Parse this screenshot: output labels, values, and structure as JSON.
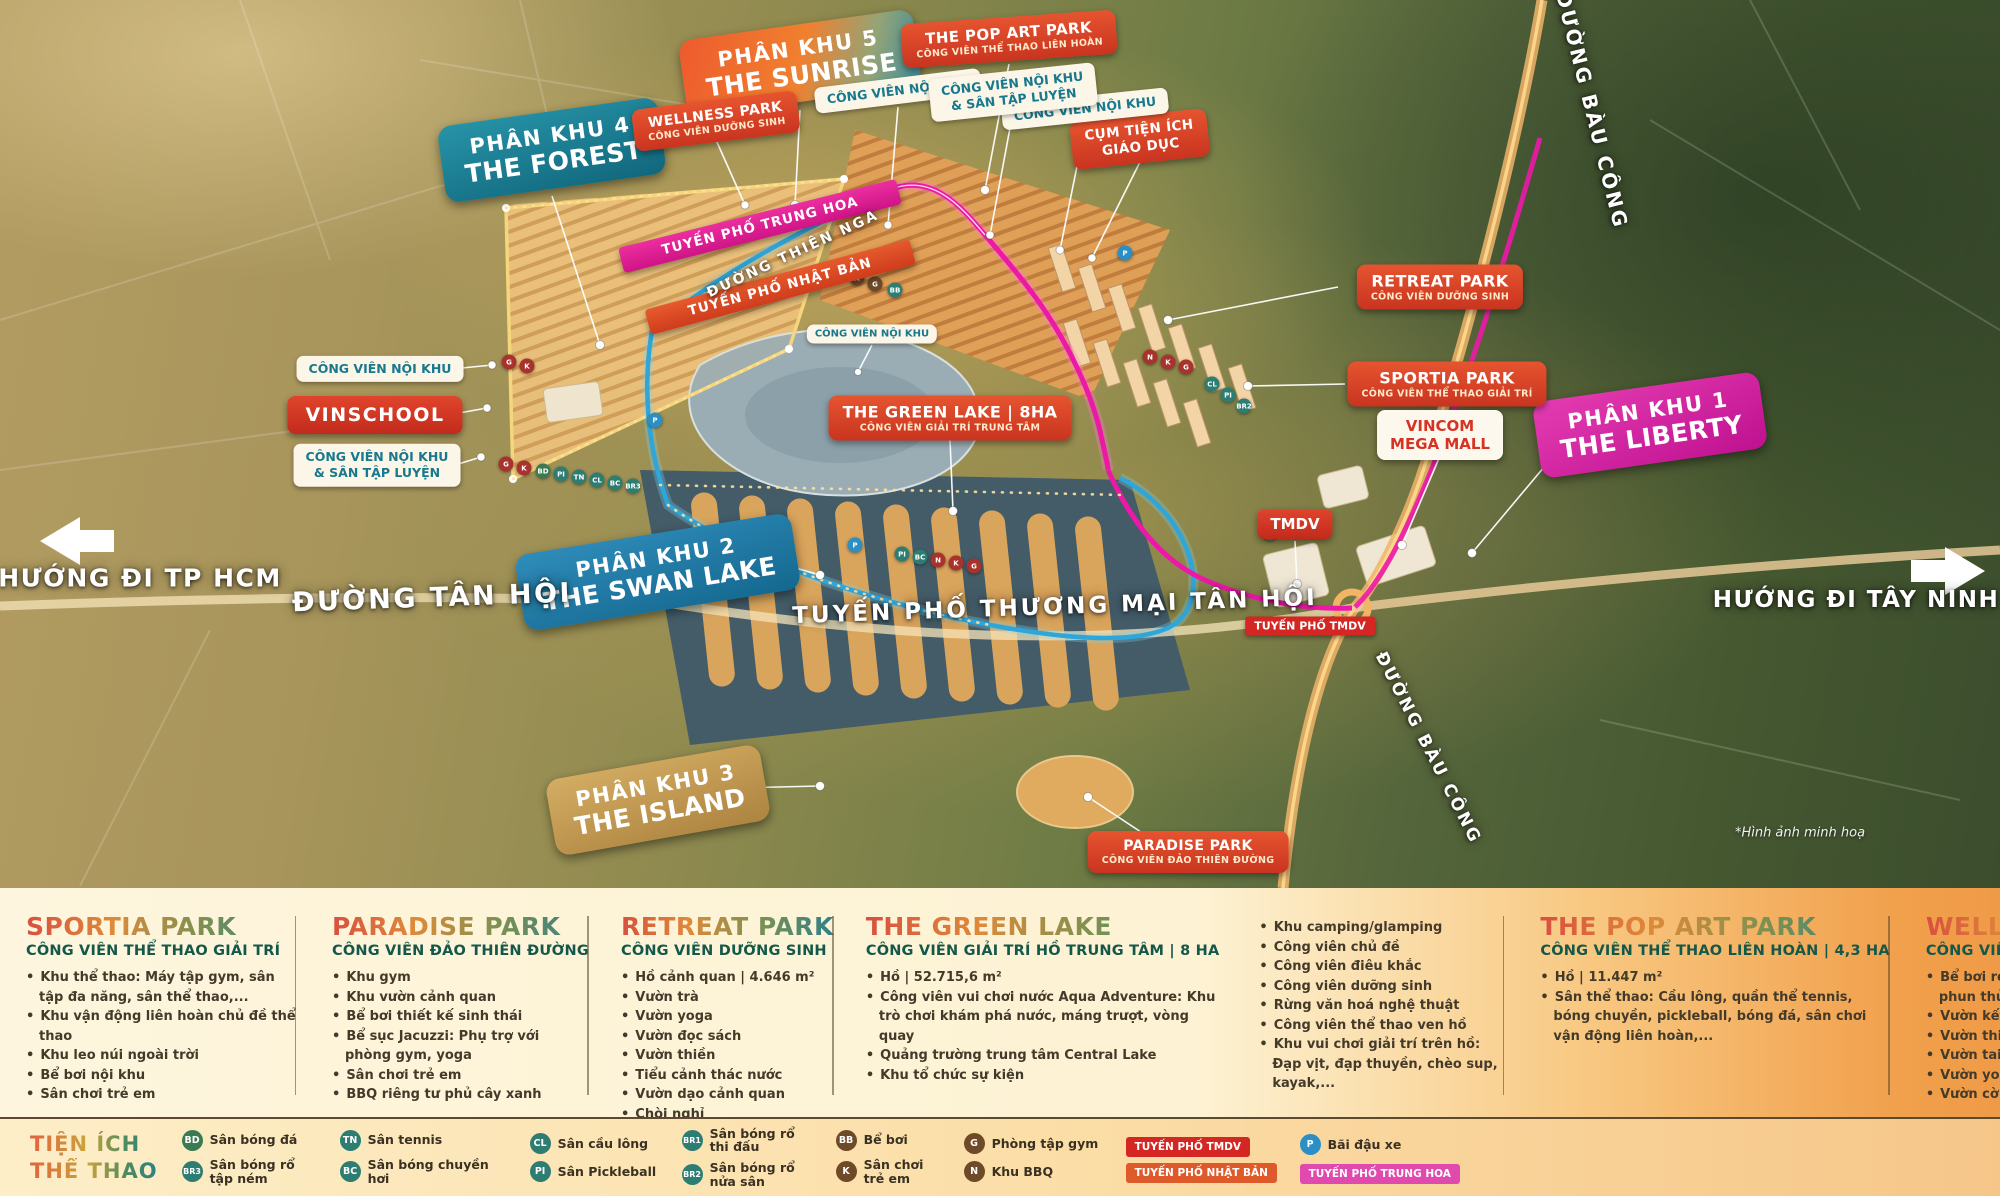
{
  "map": {
    "signs": {
      "phan_khu_4": {
        "line1": "PHÂN KHU 4",
        "line2": "THE FOREST"
      },
      "phan_khu_5": {
        "line1": "PHÂN KHU 5",
        "line2": "THE SUNRISE"
      },
      "phan_khu_1": {
        "line1": "PHÂN KHU 1",
        "line2": "THE LIBERTY"
      },
      "phan_khu_2": {
        "line1": "PHÂN KHU 2",
        "line2": "THE SWAN LAKE"
      },
      "phan_khu_3": {
        "line1": "PHÂN KHU 3",
        "line2": "THE ISLAND"
      },
      "wellness": {
        "title": "WELLNESS PARK",
        "sub": "CÔNG VIÊN DƯỠNG SINH"
      },
      "pop_art": {
        "title": "THE POP ART PARK",
        "sub": "CÔNG VIÊN THỂ THAO LIÊN HOÀN"
      },
      "retreat": {
        "title": "RETREAT PARK",
        "sub": "CÔNG VIÊN DƯỠNG SINH"
      },
      "sportia": {
        "title": "SPORTIA PARK",
        "sub": "CÔNG VIÊN THỂ THAO GIẢI TRÍ"
      },
      "green_lake": {
        "title": "THE GREEN LAKE | 8HA",
        "sub": "CÔNG VIÊN GIẢI TRÍ TRUNG TÂM"
      },
      "paradise": {
        "title": "PARADISE PARK",
        "sub": "CÔNG VIÊN ĐẢO THIÊN ĐƯỜNG"
      },
      "noi_khu": {
        "label": "CÔNG VIÊN NỘI KHU"
      },
      "noi_khu_san_tap": {
        "line1": "CÔNG VIÊN NỘI KHU",
        "line2": "& SÂN TẬP LUYỆN"
      },
      "cum_tien_ich": {
        "line1": "CỤM TIỆN ÍCH",
        "line2": "GIÁO DỤC"
      },
      "vinschool": {
        "label": "VINSCHOOL"
      },
      "vincom": {
        "line1": "VINCOM",
        "line2": "MEGA MALL"
      },
      "tmdv": {
        "label": "TMDV"
      },
      "tuyen_pho_tmdv": {
        "label": "TUYẾN PHỐ TMDV"
      },
      "trung_hoa": {
        "label": "TUYẾN PHỐ TRUNG HOA"
      },
      "nhat_ban": {
        "label": "TUYẾN PHỐ NHẬT BẢN"
      }
    },
    "roads": {
      "tan_hoi": "ĐƯỜNG TÂN HỘI",
      "thien_nga": "ĐƯỜNG THIÊN NGA",
      "bau_cong": "ĐƯỜNG BÀU CÔNG",
      "thuong_mai": "TUYẾN PHỐ THƯƠNG MẠI TÂN HỘI"
    },
    "directions": {
      "left": "HƯỚNG ĐI TP HCM",
      "right": "HƯỚNG ĐI TÂY NINH"
    },
    "note": "*Hình ảnh minh hoạ",
    "badge_codes": {
      "g": "G",
      "k": "K",
      "n": "N",
      "bb": "BB",
      "bd": "BD",
      "tn": "TN",
      "cl": "CL",
      "pi": "PI",
      "bc": "BC",
      "br1": "BR1",
      "br2": "BR2",
      "br3": "BR3",
      "p": "P"
    }
  },
  "legend": {
    "columns": [
      {
        "title": "SPORTIA PARK",
        "subtitle": "CÔNG VIÊN THỂ THAO GIẢI TRÍ",
        "items": [
          "Khu thể thao: Máy tập gym, sân tập đa năng, sân thể thao,...",
          "Khu vận động liên hoàn chủ đề thể thao",
          "Khu leo núi ngoài trời",
          "Bể bơi nội khu",
          "Sân chơi trẻ em"
        ]
      },
      {
        "title": "PARADISE PARK",
        "subtitle": "CÔNG VIÊN ĐẢO THIÊN ĐƯỜNG",
        "items": [
          "Khu gym",
          "Khu vườn cảnh quan",
          "Bể bơi thiết kế sinh thái",
          "Bể sục Jacuzzi: Phụ trợ với phòng gym, yoga",
          "Sân chơi trẻ em",
          "BBQ riêng tư phủ cây xanh"
        ]
      },
      {
        "title": "RETREAT PARK",
        "subtitle": "CÔNG VIÊN DƯỠNG SINH",
        "items": [
          "Hồ cảnh quan | 4.646 m²",
          "Vườn trà",
          "Vườn yoga",
          "Vườn đọc sách",
          "Vườn thiền",
          "Tiểu cảnh thác nước",
          "Vườn dạo cảnh quan",
          "Chòi nghỉ"
        ]
      },
      {
        "title": "THE GREEN LAKE",
        "subtitle": "CÔNG VIÊN GIẢI TRÍ HỒ TRUNG TÂM | 8 HA",
        "items": [
          "Hồ | 52.715,6 m²",
          "Công viên vui chơi nước Aqua Adventure: Khu trò chơi khám phá nước, máng trượt, vòng quay",
          "Quảng trường trung tâm Central Lake",
          "Khu tổ chức sự kiện"
        ]
      },
      {
        "title": "",
        "subtitle": "",
        "items": [
          "Khu camping/glamping",
          "Công viên chủ đề",
          "Công viên điêu khắc",
          "Công viên dưỡng sinh",
          "Rừng văn hoá nghệ thuật",
          "Công viên thể thao ven hồ",
          "Khu vui chơi giải trí trên hồ: Đạp vịt, đạp thuyền, chèo sup, kayak,..."
        ]
      },
      {
        "title": "THE POP ART PARK",
        "subtitle": "CÔNG VIÊN THỂ THAO LIÊN HOÀN | 4,3 HA",
        "items": [
          "Hồ | 11.447 m²",
          "Sân thể thao: Cầu lông, quần thể tennis, bóng chuyền, pickleball, bóng đá, sân chơi vận động liên hoàn,..."
        ]
      },
      {
        "title": "WELLNESS PARK",
        "subtitle": "CÔNG VIÊN SINH THÁI | 3,65 HA",
        "items": [
          "Bể bơi resort dưỡng sinh: Vòi phun thủy trị liệu, Jacuzzi,...",
          "Vườn kết nối cộng đồng",
          "Vườn thiền",
          "Vườn taichi",
          "Vườn yoga",
          "Vườn cờ"
        ]
      }
    ]
  },
  "footer": {
    "title_line1": "TIỆN ÍCH",
    "title_line2": "THỂ THAO",
    "items": [
      {
        "code": "BD",
        "label": "Sân bóng đá"
      },
      {
        "code": "BR3",
        "label": "Sân bóng rổ tập ném"
      },
      {
        "code": "TN",
        "label": "Sân tennis"
      },
      {
        "code": "BC",
        "label": "Sân bóng chuyền hơi"
      },
      {
        "code": "CL",
        "label": "Sân cầu lông"
      },
      {
        "code": "PI",
        "label": "Sân Pickleball"
      },
      {
        "code": "BR1",
        "label": "Sân bóng rổ thi đấu"
      },
      {
        "code": "BR2",
        "label": "Sân bóng rổ nửa sân"
      },
      {
        "code": "BB",
        "label": "Bể bơi"
      },
      {
        "code": "K",
        "label": "Sân chơi trẻ em"
      },
      {
        "code": "G",
        "label": "Phòng tập gym"
      },
      {
        "code": "N",
        "label": "Khu BBQ"
      },
      {
        "code": "P",
        "label": "Bãi đậu xe"
      }
    ],
    "road_badges": [
      {
        "label": "TUYẾN PHỐ TMDV"
      },
      {
        "label": "TUYẾN PHỐ NHẬT BẢN"
      },
      {
        "label": "TUYẾN PHỐ TRUNG HOA"
      }
    ]
  },
  "colors": {
    "teal_sign": "#1f7f93",
    "orange_sign": "#ee6a33",
    "red_sign": "#d63a28",
    "magenta_sign": "#d6219c",
    "blue_sign": "#2077a8",
    "gold_sign": "#c79d55",
    "magenta_banner": "#e0218a",
    "red_banner": "#de4f28",
    "badge_teal": "#2e7d72",
    "badge_brown": "#6f4a28",
    "badge_red": "#a8322c",
    "badge_blue": "#2b8fc4",
    "badge_green": "#3c7a52",
    "panel_cream": "#fdf3d6",
    "panel_orange": "#f2a04b",
    "boundary_magenta": "#ee18a8",
    "boundary_blue": "#2fa6da",
    "boundary_yellow": "#f4d67d"
  }
}
